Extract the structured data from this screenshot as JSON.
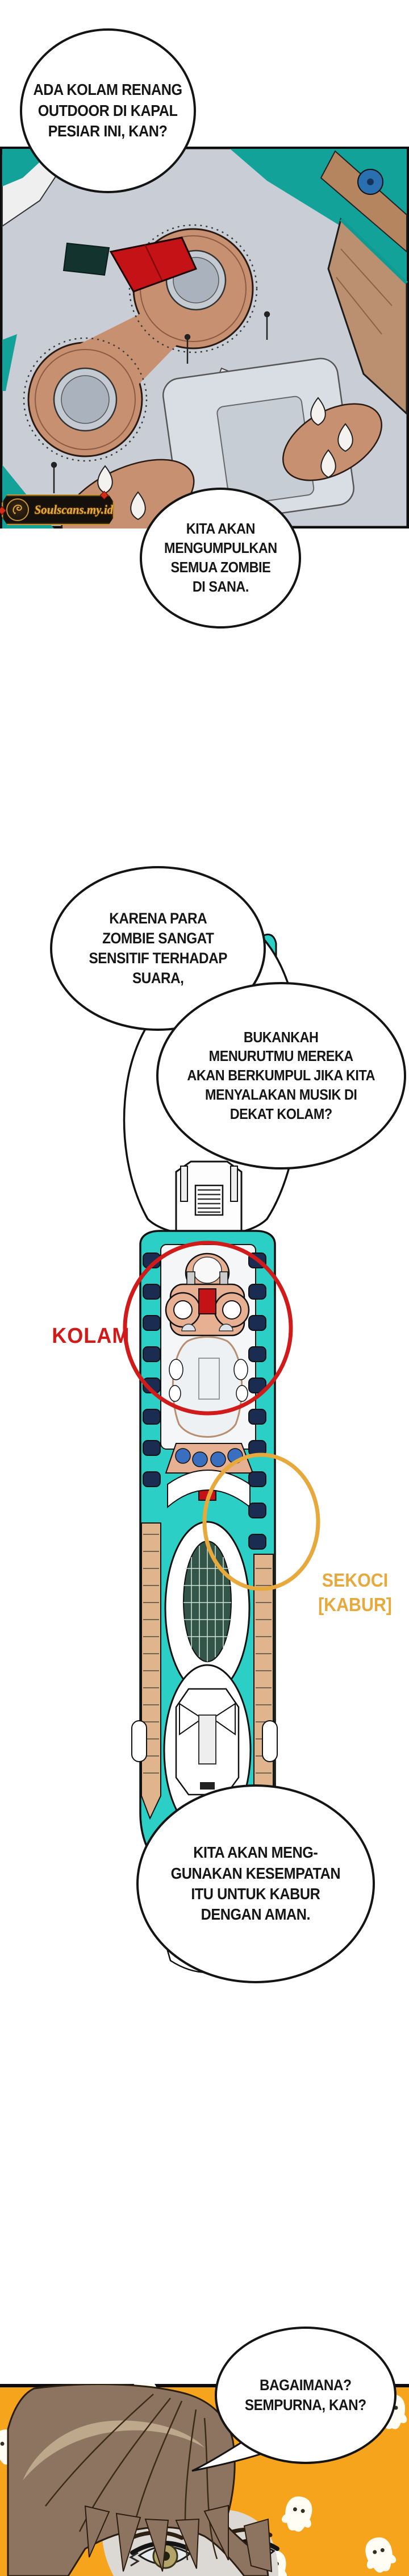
{
  "page": {
    "kind": "webtoon-comic-page",
    "bg": "#ffffff"
  },
  "speech_bubbles": [
    {
      "id": "bubble-1",
      "text": "ADA KOLAM RENANG\nOUTDOOR DI KAPAL\nPESIAR INI, KAN?"
    },
    {
      "id": "bubble-2",
      "text": "KARENA PARA\nZOMBIE SANGAT\nSENSITIF TERHADAP\nSUARA,"
    },
    {
      "id": "bubble-3",
      "text": "BUKANKAH\nMENURUTMU MEREKA\nAKAN BERKUMPUL JIKA KITA\nMENYALAKAN MUSIK DI\nDEKAT KOLAM?"
    },
    {
      "id": "bubble-4",
      "text": "KITA AKAN\nMENGUMPULKAN\nSEMUA ZOMBIE\nDI SANA."
    },
    {
      "id": "bubble-5",
      "text": "KITA AKAN MENG-\nGUNAKAN KESEMPATAN\nITU UNTUK KABUR\nDENGAN AMAN."
    },
    {
      "id": "bubble-6",
      "text": "BAGAIMANA?\nSEMPURNA, KAN?"
    }
  ],
  "annotations": {
    "kolam": "KOLAM",
    "sekoci": "SEKOCI\n[KABUR]"
  },
  "watermark": {
    "text": "Soulscans.my.id"
  },
  "colors": {
    "page_bg": "#ffffff",
    "ink": "#141414",
    "teal_deck": "#2bcfc6",
    "teal_water": "#12a29a",
    "tan_structure": "#c79070",
    "ship_tan": "#e0b58e",
    "red_canopy": "#c41216",
    "red_annotation": "#d11a1a",
    "orange_annotation": "#e7a83c",
    "panel_orange": "#f7a41d",
    "navy_lifeboat": "#1a2c52",
    "hair_brown": "#8d7460",
    "hair_highlight": "#bda88b",
    "skin": "#dcd8d3",
    "eye_iris": "#b3a469",
    "watermark_gold": "#e9aa3f",
    "watermark_bg": "#15100b"
  }
}
